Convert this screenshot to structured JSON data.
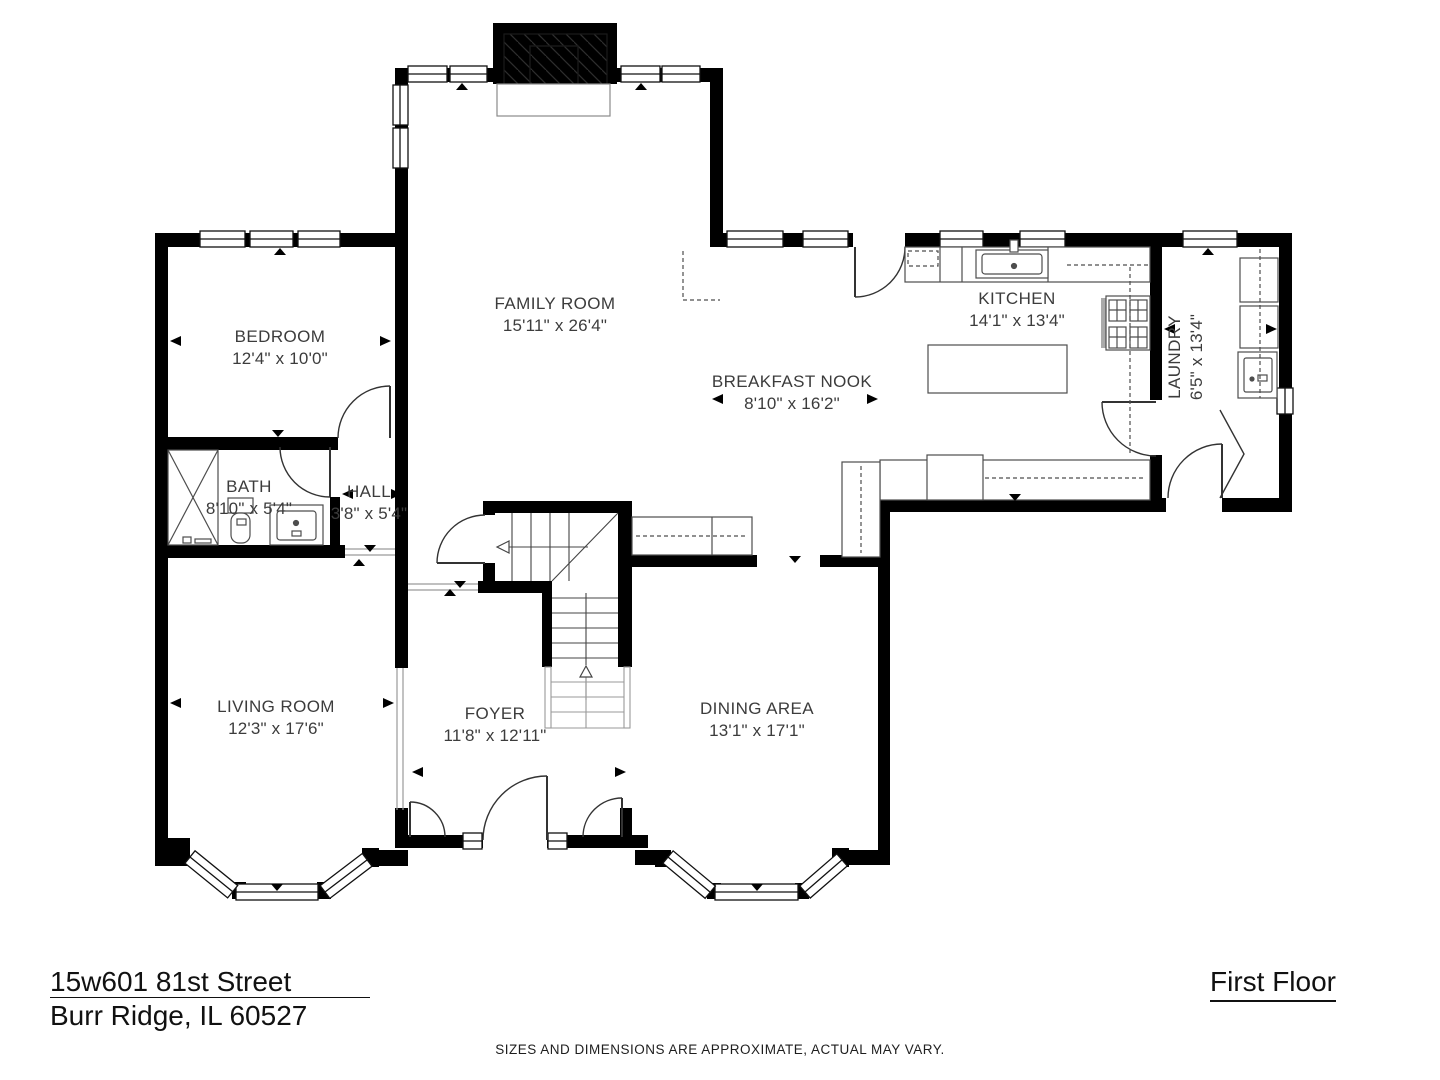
{
  "plan": {
    "floor_title": "First Floor",
    "address_line1": "15w601 81st Street",
    "address_line2": "Burr Ridge, IL 60527",
    "disclaimer": "SIZES AND DIMENSIONS ARE APPROXIMATE, ACTUAL MAY VARY.",
    "colors": {
      "wall": "#000000",
      "fixture_line": "#4d4d4d",
      "label_text": "#3c3c3c"
    },
    "rooms": [
      {
        "id": "family-room",
        "name": "FAMILY ROOM",
        "dims": "15'11\" x 26'4\"",
        "x": 555,
        "y": 293,
        "rotated": false
      },
      {
        "id": "breakfast-nook",
        "name": "BREAKFAST NOOK",
        "dims": "8'10\" x 16'2\"",
        "x": 792,
        "y": 371,
        "rotated": false
      },
      {
        "id": "kitchen",
        "name": "KITCHEN",
        "dims": "14'1\" x 13'4\"",
        "x": 1017,
        "y": 288,
        "rotated": false
      },
      {
        "id": "laundry",
        "name": "LAUNDRY",
        "dims": "6'5\" x 13'4\"",
        "x": 1186,
        "y": 357,
        "rotated": true
      },
      {
        "id": "bedroom",
        "name": "BEDROOM",
        "dims": "12'4\" x 10'0\"",
        "x": 280,
        "y": 326,
        "rotated": false
      },
      {
        "id": "bath",
        "name": "BATH",
        "dims": "8'10\" x 5'4\"",
        "x": 249,
        "y": 476,
        "rotated": false
      },
      {
        "id": "hall",
        "name": "HALL",
        "dims": "3'8\" x 5'4\"",
        "x": 369,
        "y": 481,
        "rotated": false
      },
      {
        "id": "living-room",
        "name": "LIVING ROOM",
        "dims": "12'3\" x 17'6\"",
        "x": 276,
        "y": 696,
        "rotated": false
      },
      {
        "id": "foyer",
        "name": "FOYER",
        "dims": "11'8\" x 12'11\"",
        "x": 495,
        "y": 703,
        "rotated": false
      },
      {
        "id": "dining-area",
        "name": "DINING AREA",
        "dims": "13'1\" x 17'1\"",
        "x": 757,
        "y": 698,
        "rotated": false
      }
    ]
  }
}
